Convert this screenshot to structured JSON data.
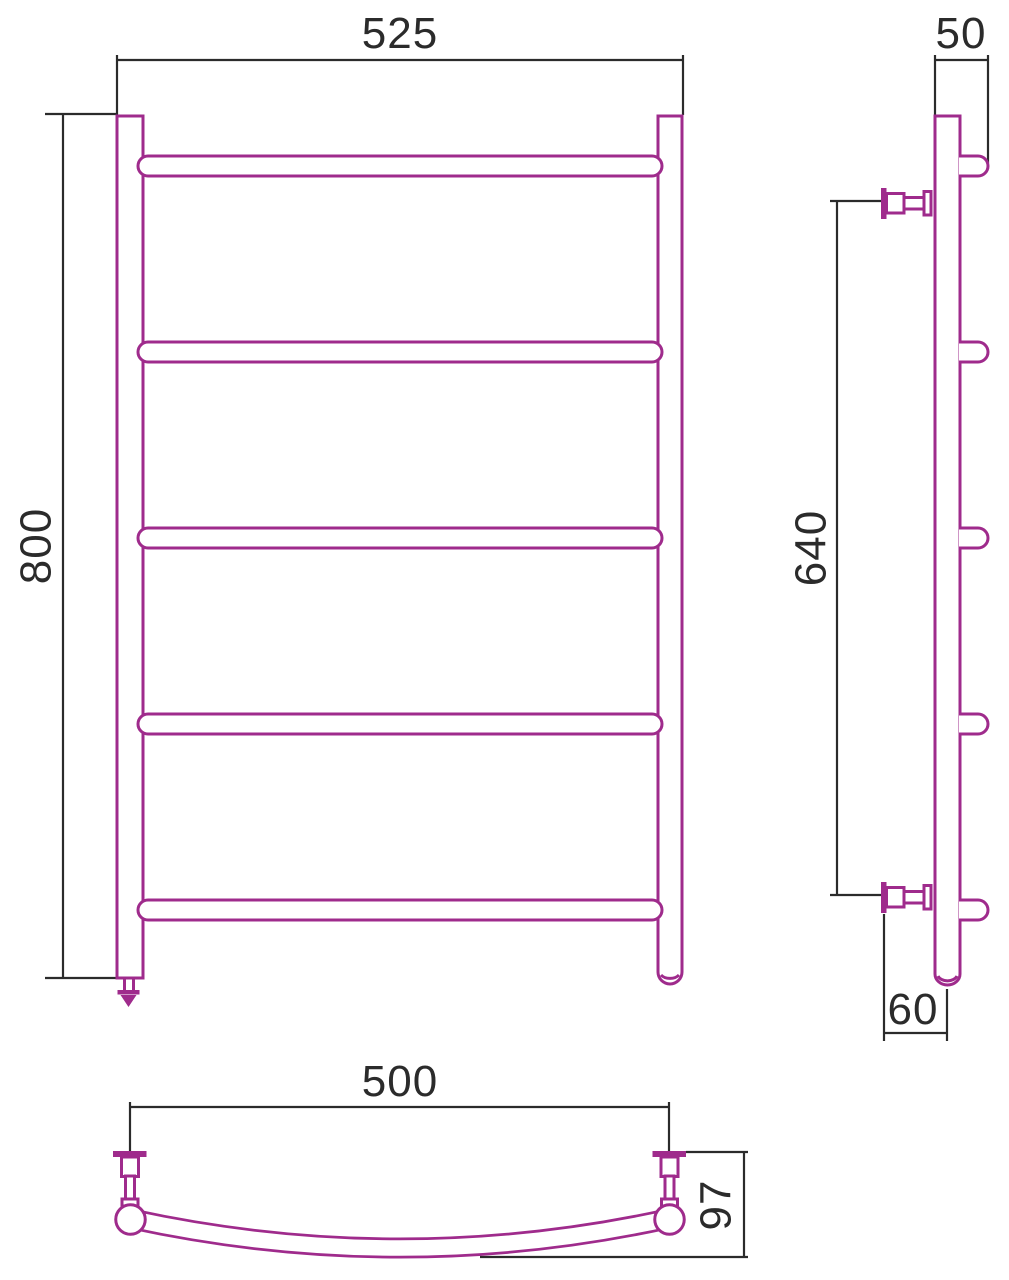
{
  "drawing": {
    "product": "ladder-towel-rail",
    "views": {
      "front": {
        "label": "front-view",
        "width_label": "525",
        "height_label": "800",
        "bar_count": 5
      },
      "side": {
        "label": "side-view",
        "depth_label": "50",
        "bracket_span_label": "640",
        "wall_offset_label": "60"
      },
      "top": {
        "label": "top-view",
        "bracket_width_label": "500",
        "depth_label": "97"
      }
    }
  },
  "colors": {
    "product": "#9F2B8C",
    "dimension": "#2B2B2B",
    "background": "#FFFFFF"
  }
}
